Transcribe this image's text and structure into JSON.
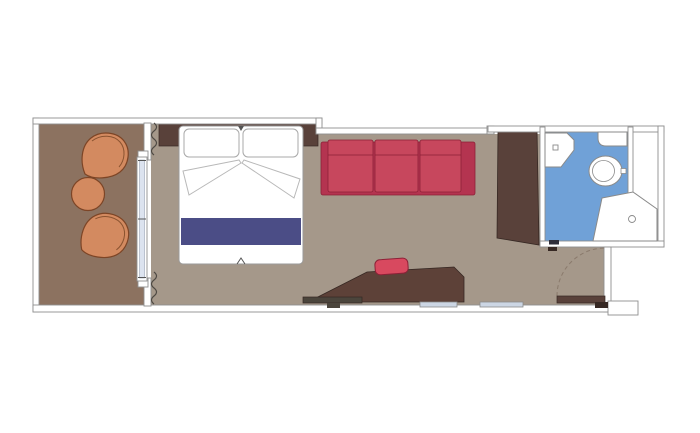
{
  "plan": {
    "kind": "cabin-floor-plan",
    "rooms": {
      "balcony": {
        "name": "balcony",
        "items": [
          "armchair",
          "side-table",
          "armchair"
        ]
      },
      "bedroom": {
        "name": "cabin",
        "items": [
          "headboard",
          "double-bed",
          "pillow",
          "pillow",
          "sofa",
          "desk",
          "stool",
          "bench",
          "wardrobe",
          "mirror",
          "mirror",
          "sliding-glass-door",
          "curtains"
        ]
      },
      "bathroom": {
        "name": "bathroom",
        "items": [
          "washbasin",
          "shelf",
          "toilet",
          "shower"
        ]
      },
      "entry": {
        "name": "entry",
        "items": [
          "entrance-door",
          "bathroom-door"
        ]
      }
    }
  },
  "colors": {
    "page_bg": "#ffffff",
    "wall_fill": "#ffffff",
    "wall_line": "#8f8f8f",
    "cabin_floor": "#a5988a",
    "balcony_floor": "#8c7260",
    "bathroom_floor": "#70a1d7",
    "bathroom_edge": "#4a7cb0",
    "dark_wood": "#59413a",
    "wood_outline": "#362823",
    "desk_wood": "#5d4138",
    "sofa_base": "#b43450",
    "sofa_cushion": "#c7475d",
    "sofa_outline": "#8c2137",
    "stool_red": "#d8495f",
    "bed_navy": "#4b4d86",
    "bed_white": "#ffffff",
    "bed_outline": "#9a9a9a",
    "pillow_outline": "#a8a8a8",
    "fold_line": "#b8b8b8",
    "chair_orange": "#d38a60",
    "chair_outline": "#7d4526",
    "chair_back_line": "#8a5330",
    "glass_blue": "#dce3ef",
    "glass_line": "#9aa4b4",
    "mirror_blue": "#ccd6e4",
    "fixture_outline": "#8a8a8a",
    "curtain_line": "#4f4a44",
    "door_arc": "#8a7a6c",
    "bench_gray": "#4b453c",
    "notch_dark": "#555555"
  }
}
